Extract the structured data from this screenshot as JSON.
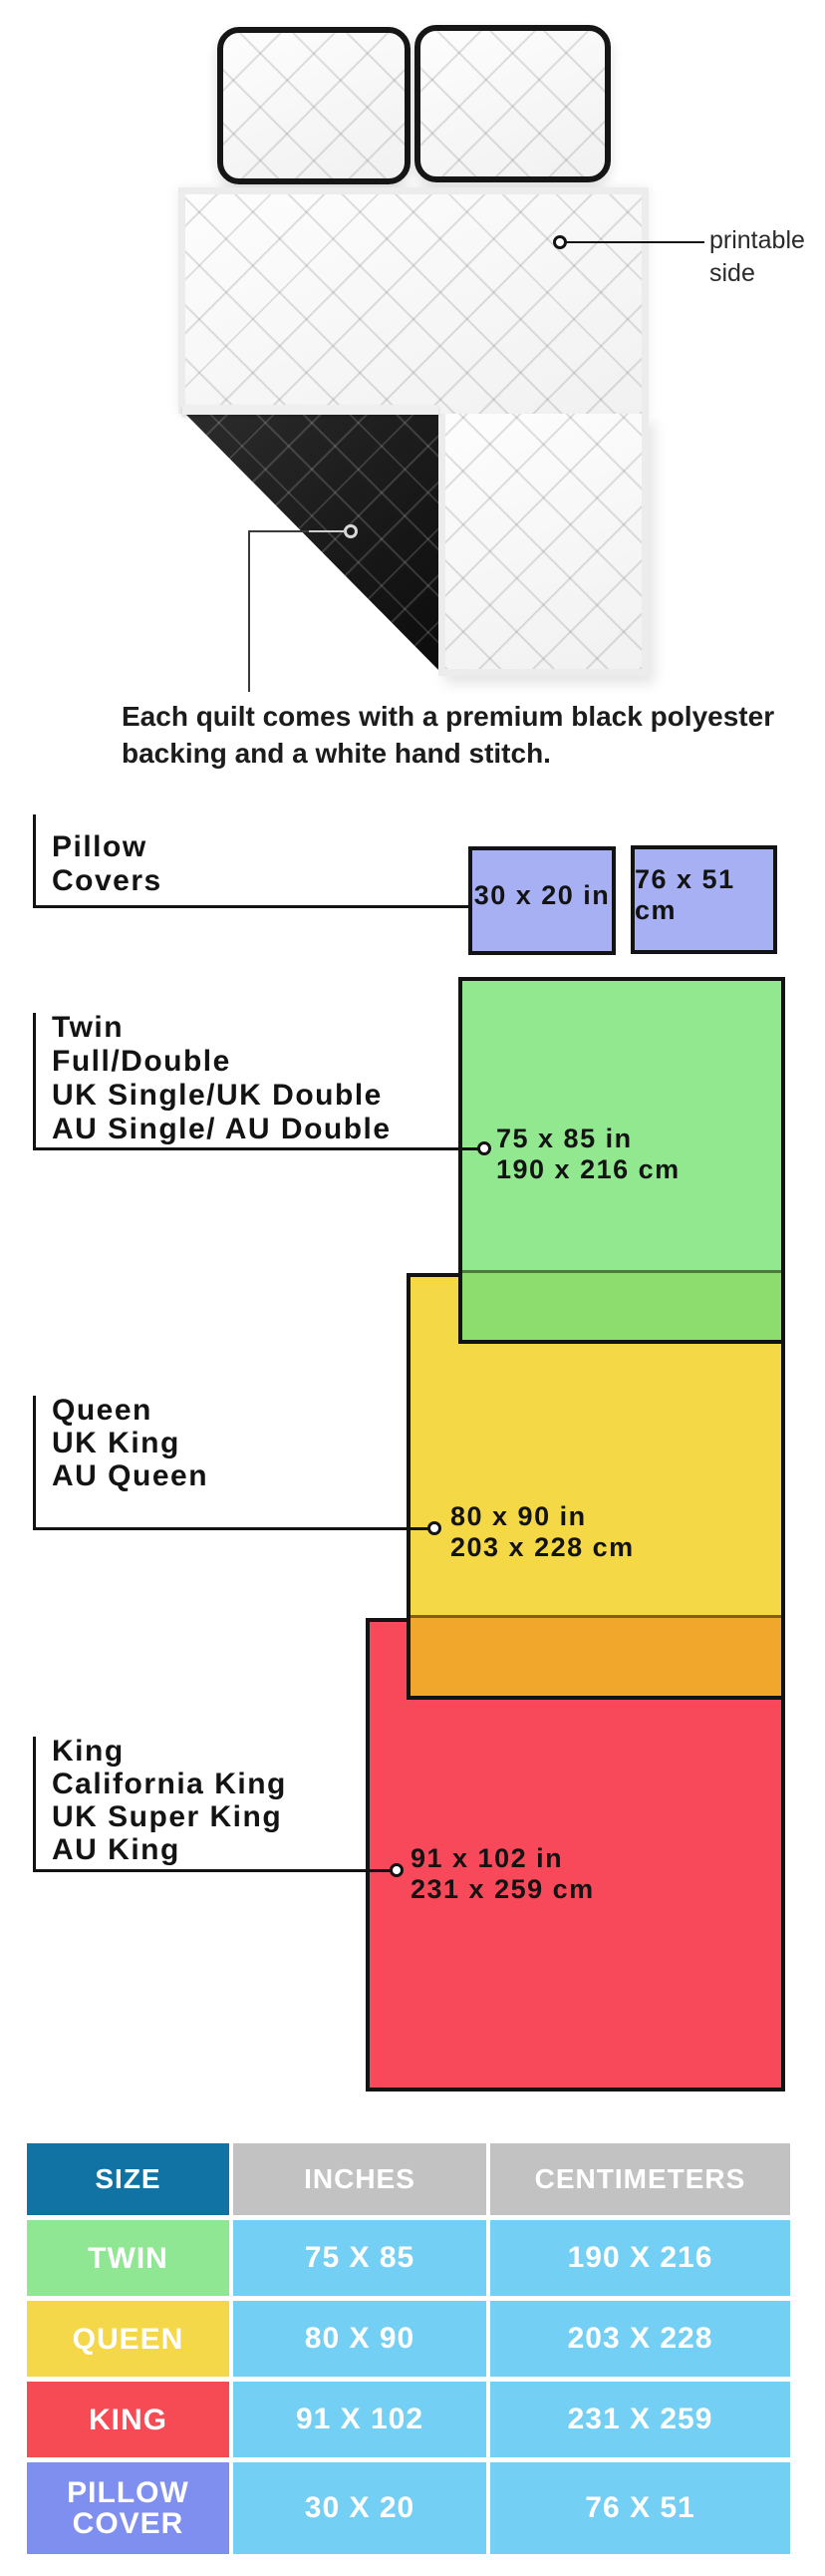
{
  "colors": {
    "line_black": "#131313",
    "blue_box": "#a6b0f2",
    "blue_row": "#7f8ff0",
    "green": "#92e88f",
    "green_overlap": "#8cdd6d",
    "yellow": "#f5d845",
    "orange_overlap": "#f1a72b",
    "red": "#f7495a",
    "teal_header": "#1173a3",
    "gray_header": "#c2c2c2",
    "cell_blue": "#73cff4",
    "green_cell": "#90e793",
    "yellow_cell": "#f5d74a",
    "red_cell": "#f64a54"
  },
  "illustration": {
    "printable_side_label": "printable side",
    "caption_line1": "Each quilt comes with a premium black polyester",
    "caption_line2": "backing and a white hand stitch."
  },
  "diagram": {
    "pillow_covers": {
      "label": "Pillow Covers",
      "box_in": "30 x 20 in",
      "box_cm": "76 x 51 cm"
    },
    "twin": {
      "names": [
        "Twin",
        "Full/Double",
        "UK Single/UK Double",
        "AU Single/ AU Double"
      ],
      "size_in": "75 x 85 in",
      "size_cm": "190 x 216 cm"
    },
    "queen": {
      "names": [
        "Queen",
        "UK King",
        "AU Queen"
      ],
      "size_in": "80 x 90 in",
      "size_cm": "203 x 228 cm"
    },
    "king": {
      "names": [
        "King",
        "California King",
        "UK Super King",
        "AU King"
      ],
      "size_in": "91 x 102 in",
      "size_cm": "231 x 259 cm"
    }
  },
  "table": {
    "headers": {
      "size": "SIZE",
      "inches": "INCHES",
      "centimeters": "CENTIMETERS"
    },
    "rows": [
      {
        "size": "TWIN",
        "inches": "75 X 85",
        "centimeters": "190 X 216"
      },
      {
        "size": "QUEEN",
        "inches": "80 X 90",
        "centimeters": "203 X 228"
      },
      {
        "size": "KING",
        "inches": "91 X 102",
        "centimeters": "231 X 259"
      },
      {
        "size": "PILLOW COVER",
        "inches": "30 X 20",
        "centimeters": "76 X 51"
      }
    ]
  }
}
